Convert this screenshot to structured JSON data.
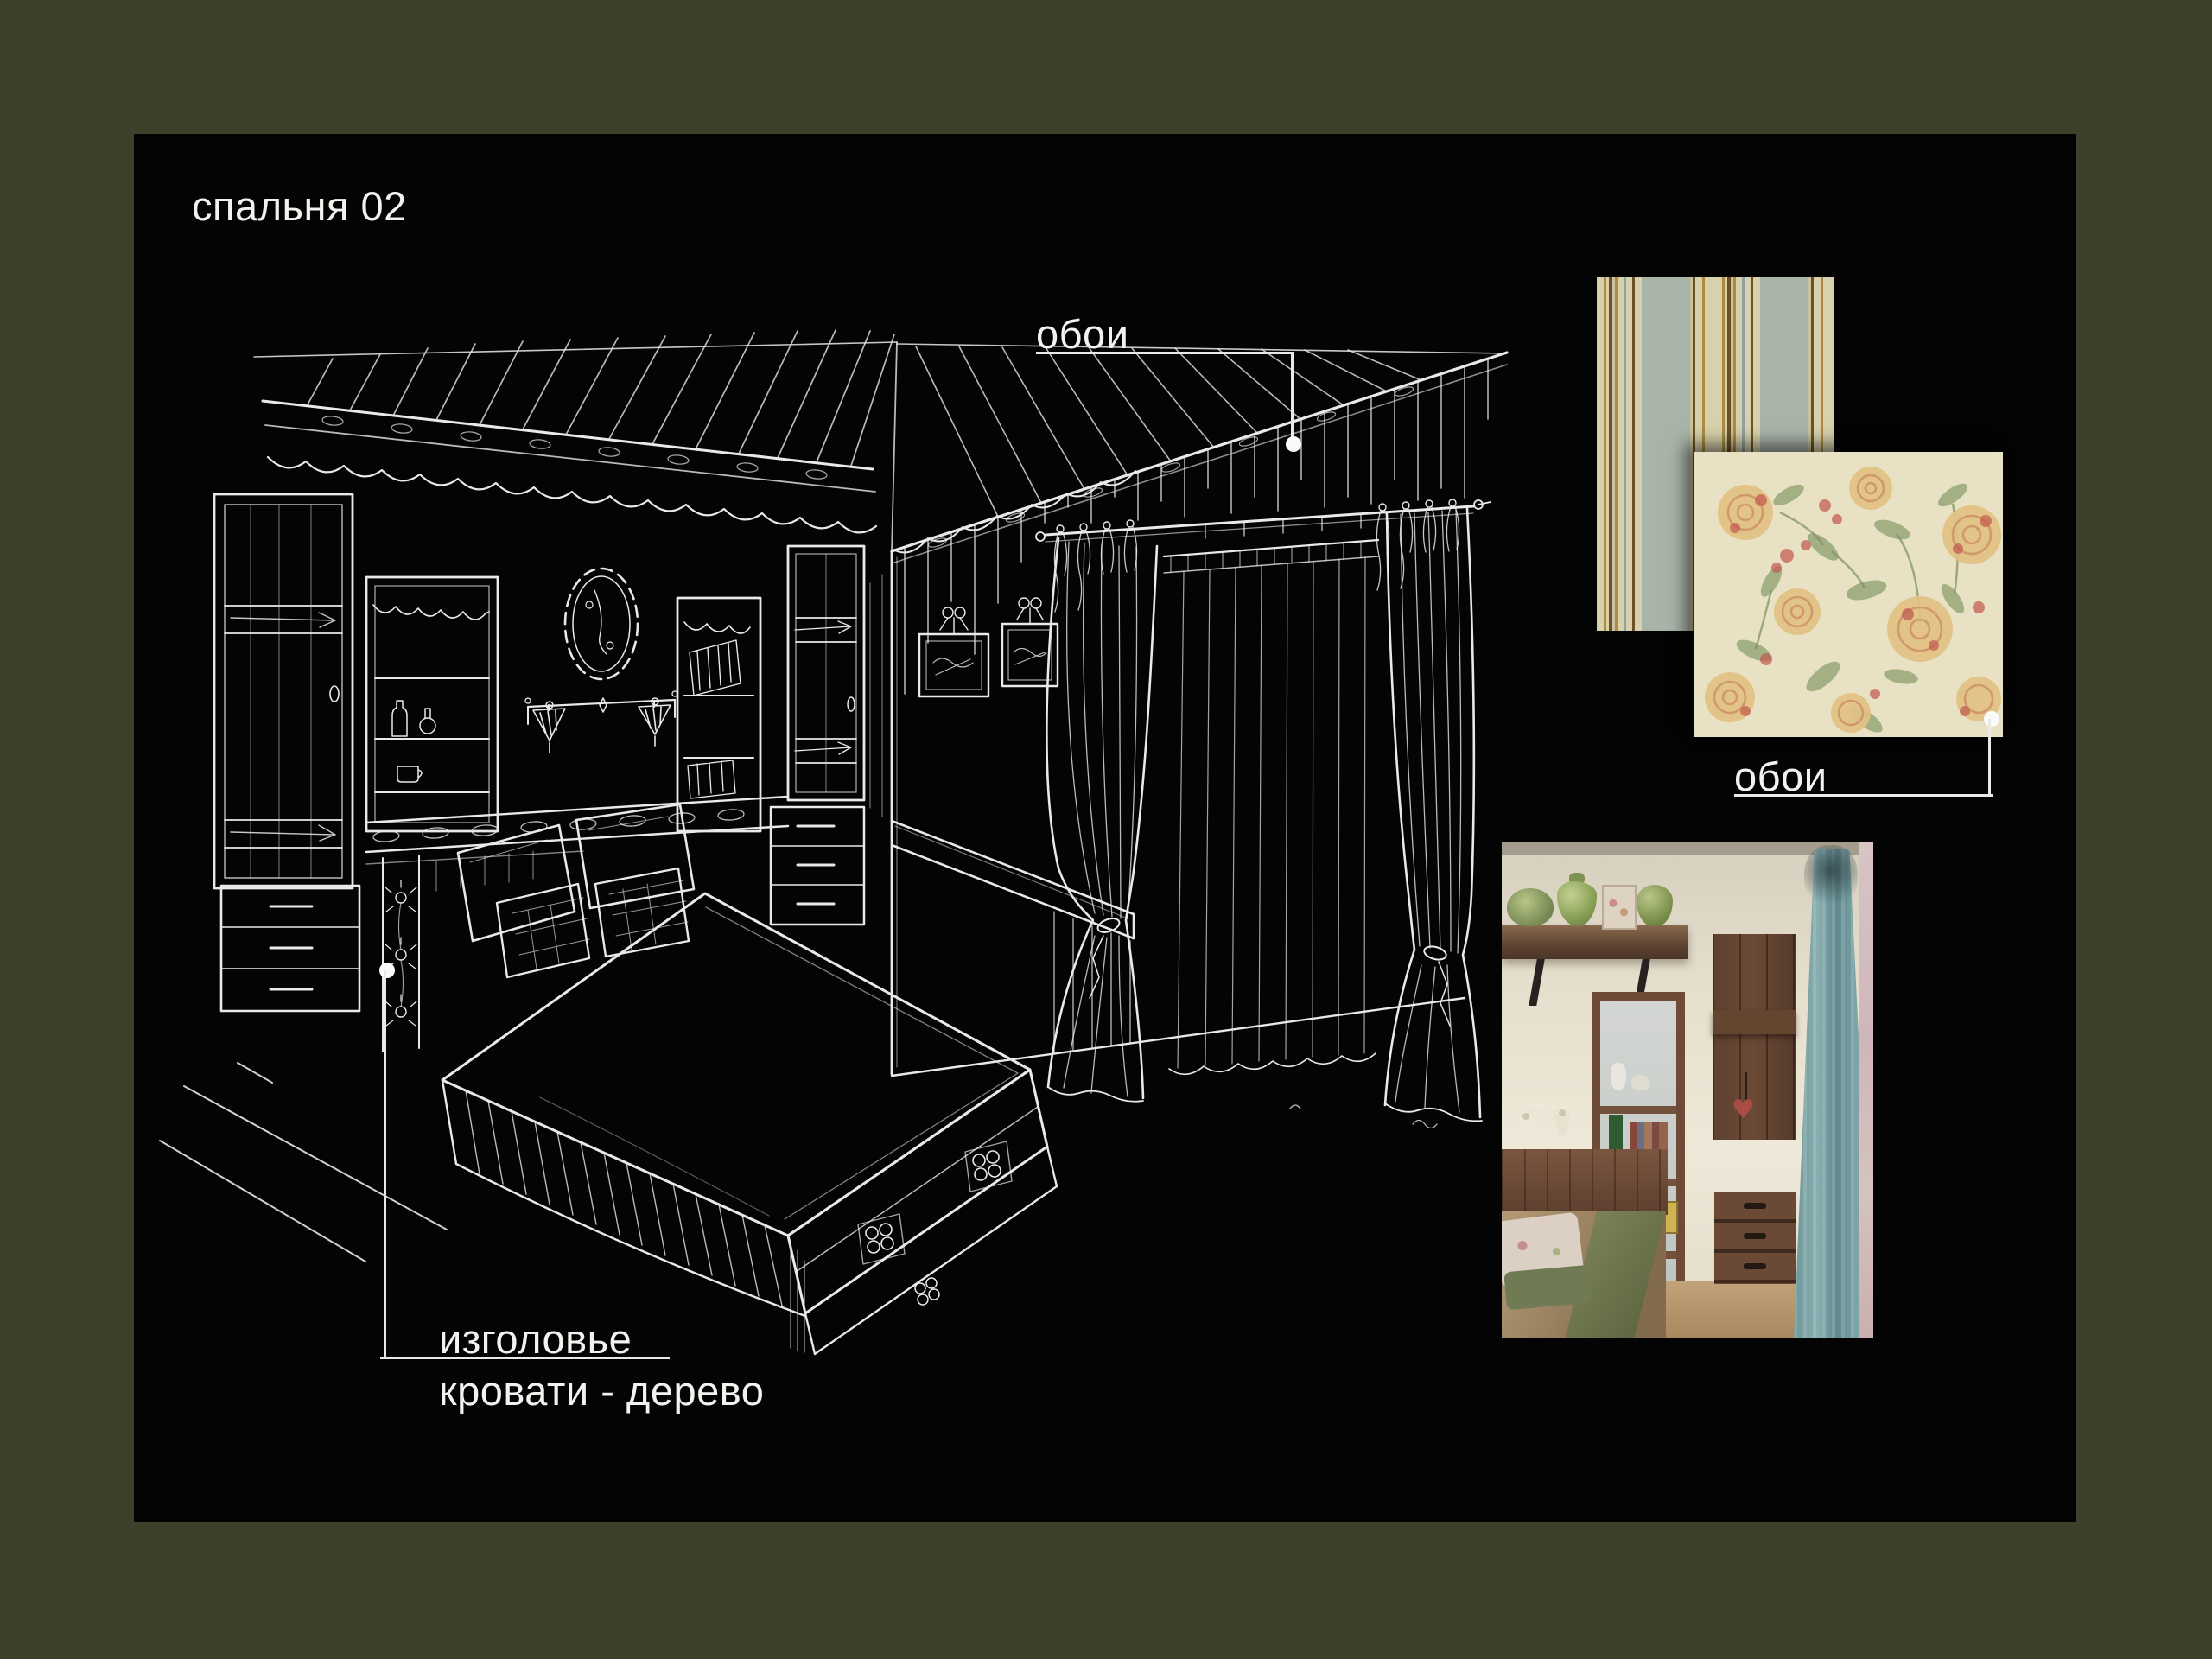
{
  "page": {
    "border_color": "#3d402a",
    "canvas_color": "#040404",
    "text_color": "#f3f2ee",
    "line_color": "#e9e9e6"
  },
  "title": "спальня 02",
  "sketch": {
    "name": "bedroom perspective sketch",
    "stroke_color": "#f4f4f1"
  },
  "callouts": {
    "wallpaper_sketch": {
      "label": "обои"
    },
    "wallpaper_swatch": {
      "label": "обои"
    },
    "headboard": {
      "line1": "изголовье",
      "line2": "кровати - дерево"
    }
  },
  "swatches": {
    "striped": {
      "name": "striped wallpaper sample",
      "colors": {
        "cream": "#d8d1ab",
        "sage": "#a9b4a9",
        "gold": "#ab8c41",
        "brown": "#6a5226",
        "blue": "#8fa3a1"
      }
    },
    "floral": {
      "name": "floral wallpaper sample",
      "colors": {
        "base": "#e8e1c3",
        "rose": "#e2c183",
        "rose_deep": "#cd9268",
        "red": "#c2584e",
        "leaf": "#8da06f"
      }
    }
  },
  "photo": {
    "name": "bedroom reference photo"
  }
}
